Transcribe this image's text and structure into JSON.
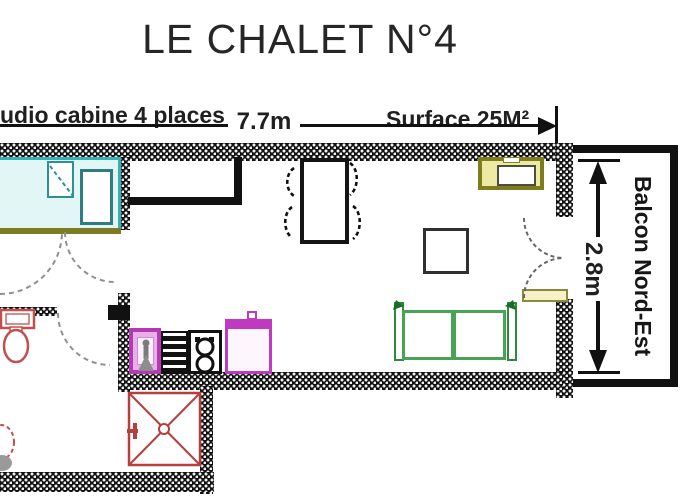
{
  "header": {
    "title": "LE CHALET N°4",
    "subtitle": "udio cabine 4 places",
    "surface": "Surface 25M²"
  },
  "dimensions": {
    "width": "7.7m",
    "height": "2.8m"
  },
  "balcony": {
    "label": "Balcon Nord-Est"
  },
  "colors": {
    "wall": "#121212",
    "bed_cyan": "#35b2b6",
    "sofa_green": "#49a356",
    "kitchen_magenta": "#bf3abf",
    "bathroom_red": "#c0504d",
    "tv_olive": "#7d7d1d",
    "radiator_khaki": "#8a8a3a",
    "shower_red": "#b2403c"
  }
}
